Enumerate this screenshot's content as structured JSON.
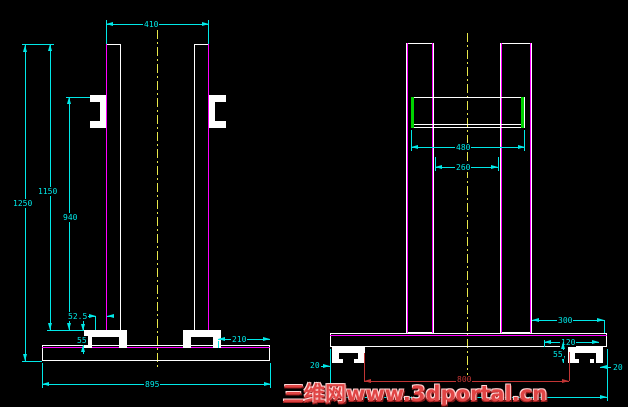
{
  "colors": {
    "background": "#000000",
    "dimension": "#00e8e8",
    "object": "#ffffff",
    "face_lines": "#ff00ff",
    "beam_edge": "#00d400",
    "centerline": "#e8e84a",
    "red_dimension": "#c23535",
    "watermark": "#e04545"
  },
  "front": {
    "dims": {
      "top_width": "410",
      "overall_height": "1250",
      "upper_height": "1150",
      "bracket_height": "940",
      "bracket_offset": "52.5",
      "foot_height": "55",
      "base_right_margin": "210",
      "base_width": "895"
    }
  },
  "side": {
    "dims": {
      "beam_width": "480",
      "column_gap": "260",
      "base_right_margin": "300",
      "foot_width": "120",
      "foot_height": "55",
      "left_overhang": "20",
      "right_overhang": "20",
      "feet_span": "800"
    }
  },
  "watermark": {
    "text": "三维网www.3dportal.cn"
  }
}
